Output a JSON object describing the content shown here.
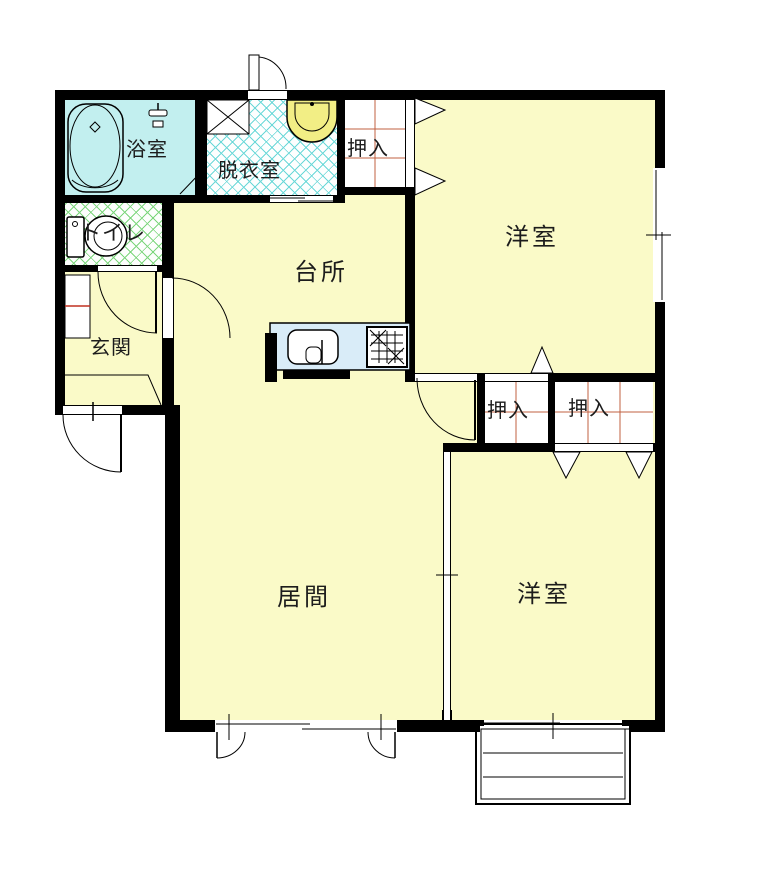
{
  "floorplan": {
    "type": "japanese-apartment-floor-plan",
    "rooms": {
      "bathroom": "浴室",
      "dressing_room": "脱衣室",
      "toilet": "トイレ",
      "entrance": "玄関",
      "kitchen": "台所",
      "living_room": "居間",
      "western_room_top": "洋室",
      "western_room_bottom": "洋室",
      "closet_top": "押入",
      "closet_mid_left": "押入",
      "closet_mid_right": "押入"
    },
    "fixtures": [
      "bathtub-icon",
      "shower-icon",
      "toilet-icon",
      "washbasin-icon",
      "washing-machine-pan-icon",
      "kitchen-sink-icon",
      "stove-icon",
      "shoe-cabinet-icon",
      "balcony-fence",
      "entrance-step"
    ],
    "colors": {
      "wall": "#000000",
      "room_fill": "#fafac8",
      "bathroom_fill": "#c2efef",
      "dressing_hatch": "#6bd8d8",
      "toilet_hatch": "#7cd67c",
      "closet_grid": "#c06040",
      "counter_fill": "#d9ecf8",
      "basin_fill": "#f2ee85",
      "shoe_shelf_line": "#c03020"
    }
  }
}
